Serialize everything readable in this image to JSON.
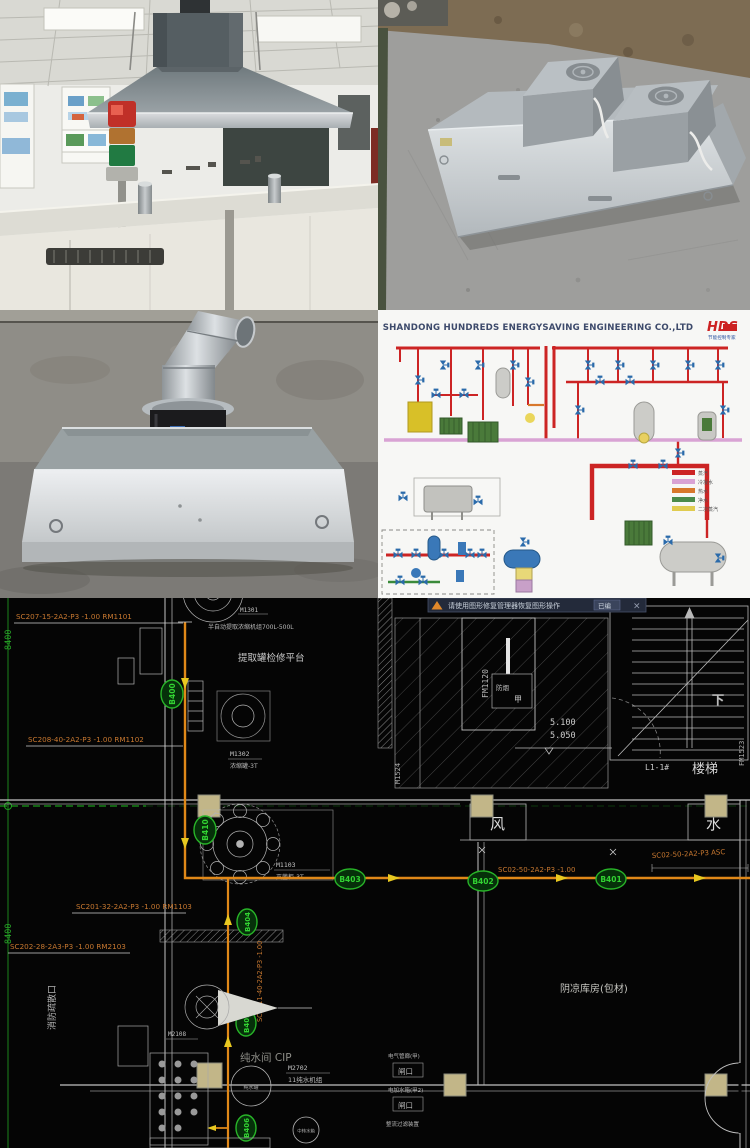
{
  "diagram": {
    "title": "SHANDONG HUNDREDS ENERGYSAVING ENGINEERING CO.,LTD",
    "logo": "HDS",
    "logo_sub": "节能控制专家",
    "legend": [
      {
        "label": "蒸汽",
        "color": "#cc2424"
      },
      {
        "label": "冷凝水",
        "color": "#d9a3d4"
      },
      {
        "label": "热水",
        "color": "#d8782c"
      },
      {
        "label": "净水",
        "color": "#4a8a4a"
      },
      {
        "label": "二次蒸汽",
        "color": "#e0cc50"
      }
    ]
  },
  "cad": {
    "notification": {
      "message": "请使用图形修复管理器恢复图形操作",
      "button": "已编",
      "close": "×"
    },
    "pipe_labels": {
      "sc207": "SC207-15-2A2-P3 -1.00 RM1101",
      "sc208": "SC208-40-2A2-P3 -1.00 RM1102",
      "sc201": "SC201-32-2A2-P3 -1.00 RM1103",
      "sc202": "SC202-28-2A3-P3 -1.00 RM2103",
      "sc02": "SC02-50-2A2-P3 -1.00",
      "sc02b": "SC02-50-2A2-P3 ASC",
      "sc2011": "SC2011-40-2A2-P3 -1.00"
    },
    "tags": [
      "B400",
      "B410",
      "B403",
      "B402",
      "B401",
      "B404",
      "B405",
      "B406"
    ],
    "equipment": {
      "m1301": "M1301",
      "m1301_desc": "半自动提取浓缩机组700L-500L",
      "platform": "提取罐检修平台",
      "m1302": "M1302",
      "m1302_desc": "浓缩罐-3T",
      "m1103": "M1103",
      "m1103_desc": "灭菌柜-3T",
      "m1524": "M1524",
      "fm1523": "FM1523",
      "fm1120": "FM1120",
      "m2108": "M2108",
      "m2702": "M2702",
      "m2702_desc": "11纯水机组",
      "tank1": "纯水罐",
      "tank2": "中转水箱"
    },
    "rooms": {
      "stair_id": "L1-1#",
      "stair": "楼梯",
      "down": "下",
      "feng": "风",
      "shui": "水",
      "jia": "甲",
      "fangyan": "防烟",
      "pure": "纯水间 CIP",
      "warehouse": "阴凉库房(包材)",
      "fire_exit": "消防疏散口",
      "r1": "电气管廊(甲)",
      "r2": "闸口",
      "r3": "电加水箱(甲2)",
      "r4": "闸口",
      "r5": "整流过滤装置"
    },
    "elevations": {
      "e1": "5.100",
      "e2": "5.050"
    },
    "dims": {
      "d8400a": "8400",
      "d8400b": "8400"
    }
  }
}
